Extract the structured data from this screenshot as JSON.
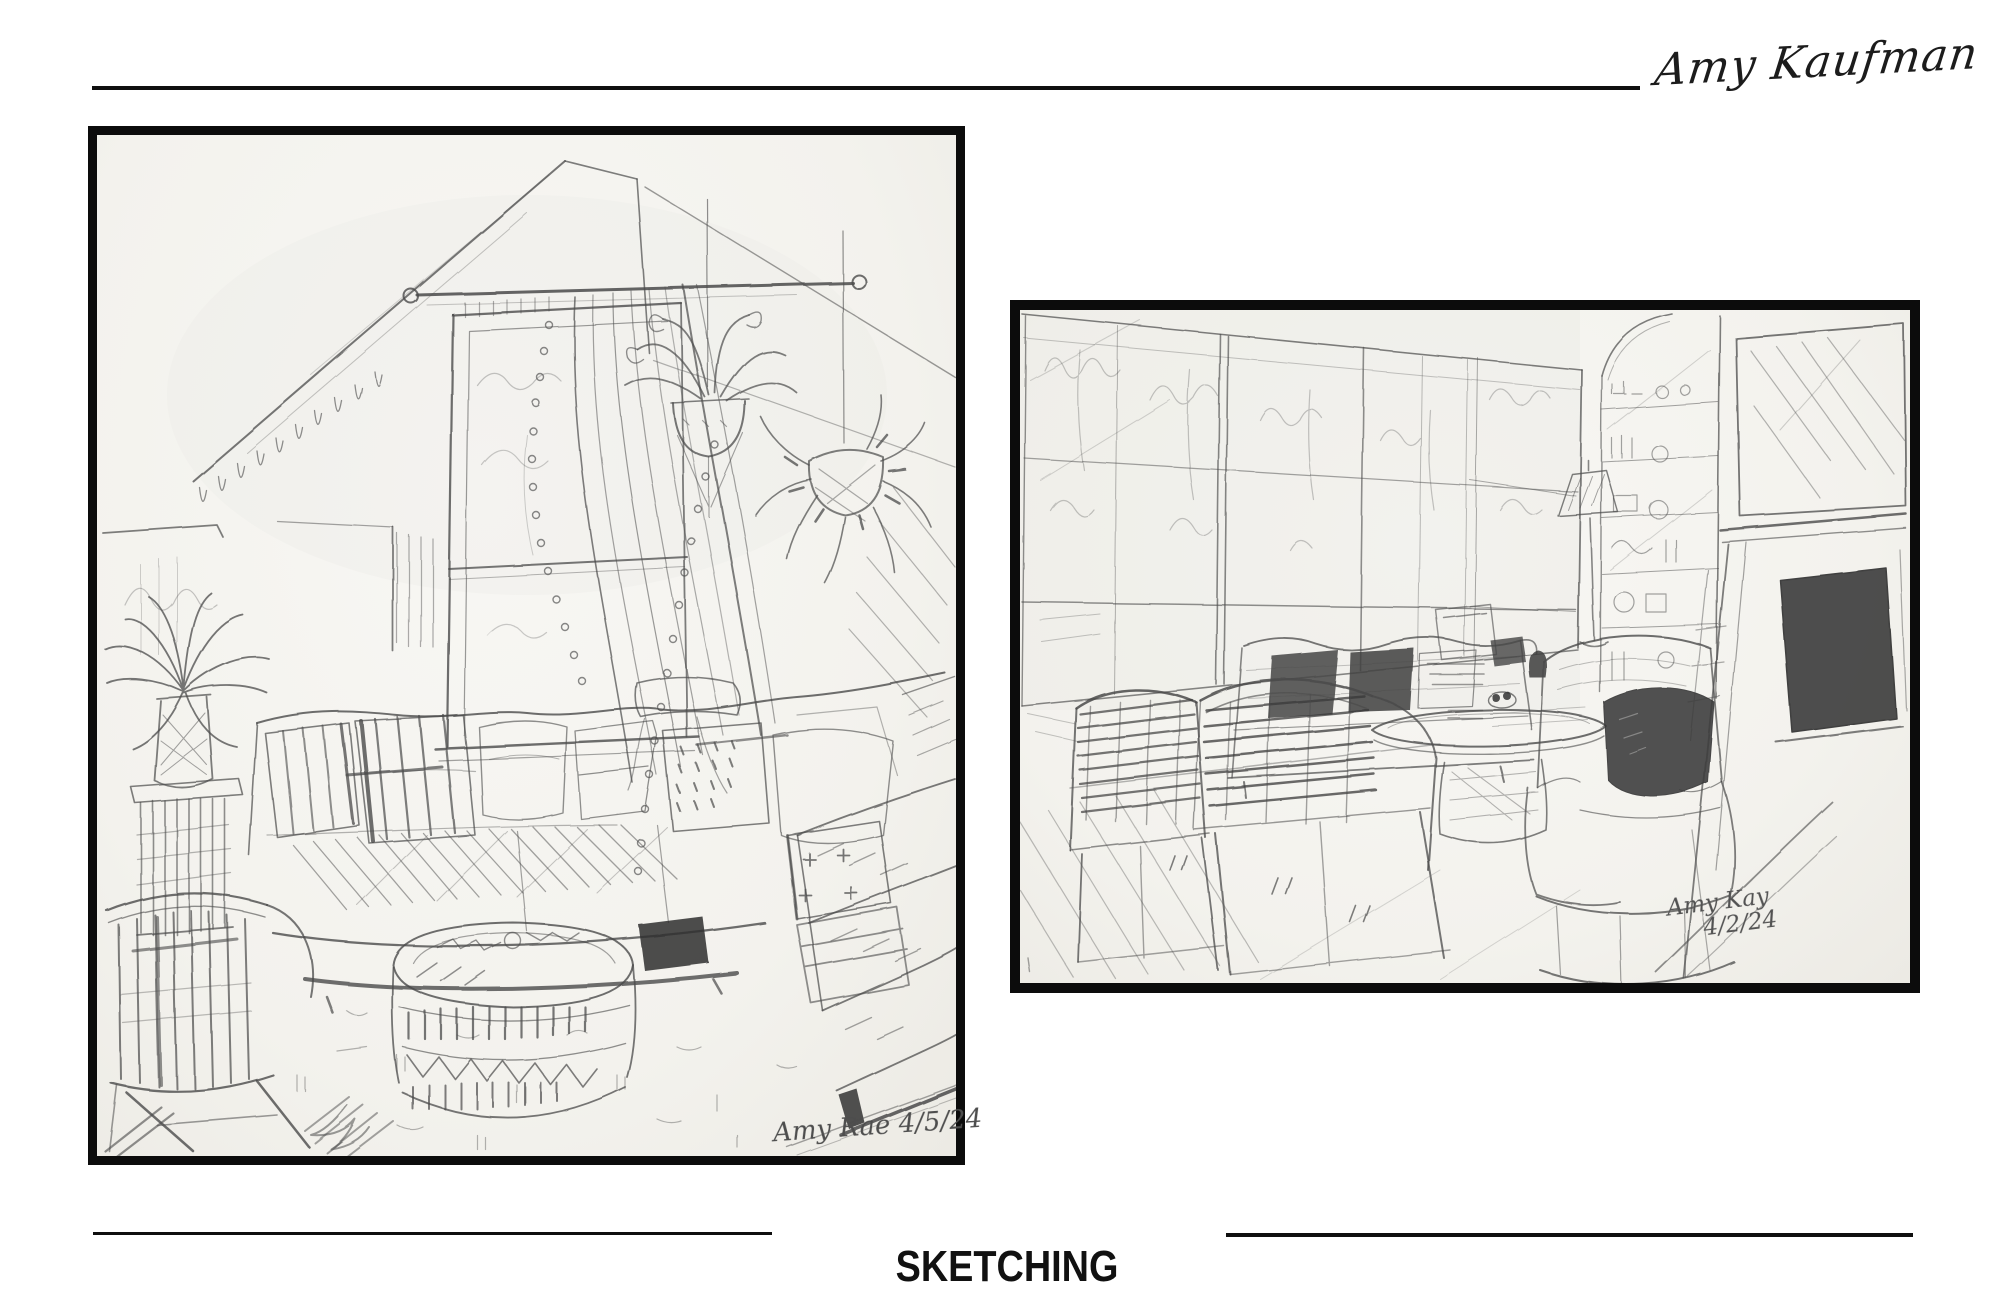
{
  "colors": {
    "ink": "#0c0c0c",
    "pencil": "#4a4a4a",
    "paper": "#f5f4f0",
    "background": "#ffffff"
  },
  "header": {
    "artist_signature": "Amy Kaufman"
  },
  "footer": {
    "section_title": "SKETCHING"
  },
  "artworks": [
    {
      "label": "attic-living-room-sketch",
      "signature": "Amy Rae",
      "date": "4/5/24"
    },
    {
      "label": "living-room-fireplace-sketch",
      "signature": "Amy Kay",
      "date": "4/2/24"
    }
  ]
}
